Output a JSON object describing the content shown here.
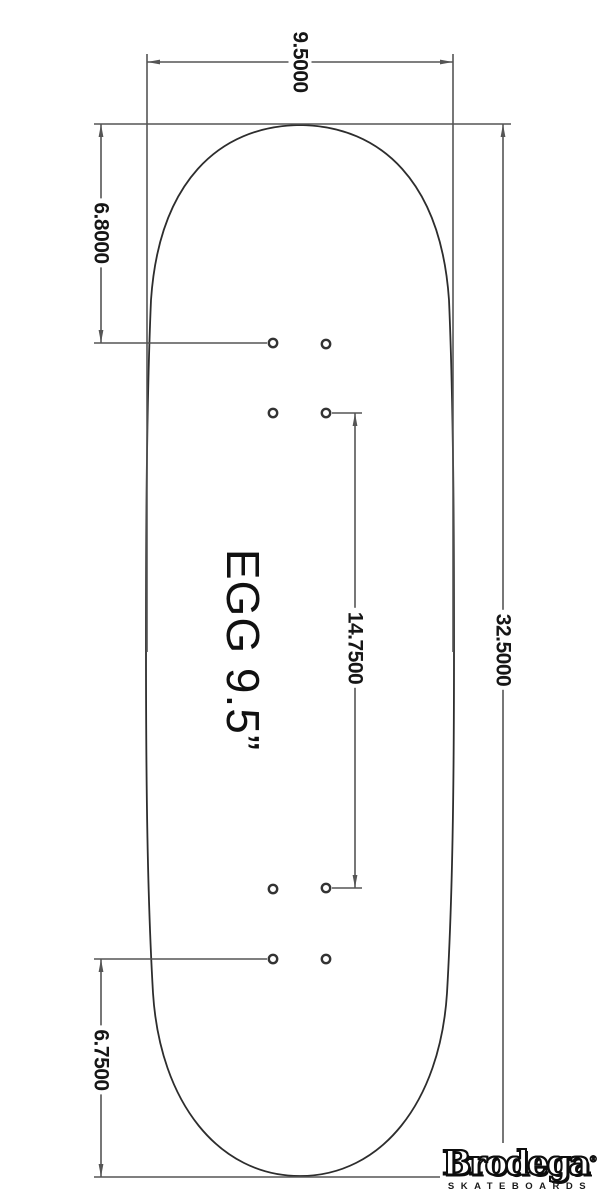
{
  "deck": {
    "name": "EGG 9.5”"
  },
  "dimensions": {
    "width_in": "9.5000",
    "nose_in": "6.8000",
    "length_in": "32.5000",
    "wheelbase_in": "14.7500",
    "tail_in": "6.7500"
  },
  "logo": {
    "brand": "Brodega",
    "registered_mark": "®",
    "subtitle": "SKATEBOARDS"
  },
  "colors": {
    "background": "#ffffff",
    "dimension_line": "#555555",
    "deck_outline": "#2d2d2d",
    "hole_ring": "#333333",
    "label_text": "#161616"
  }
}
